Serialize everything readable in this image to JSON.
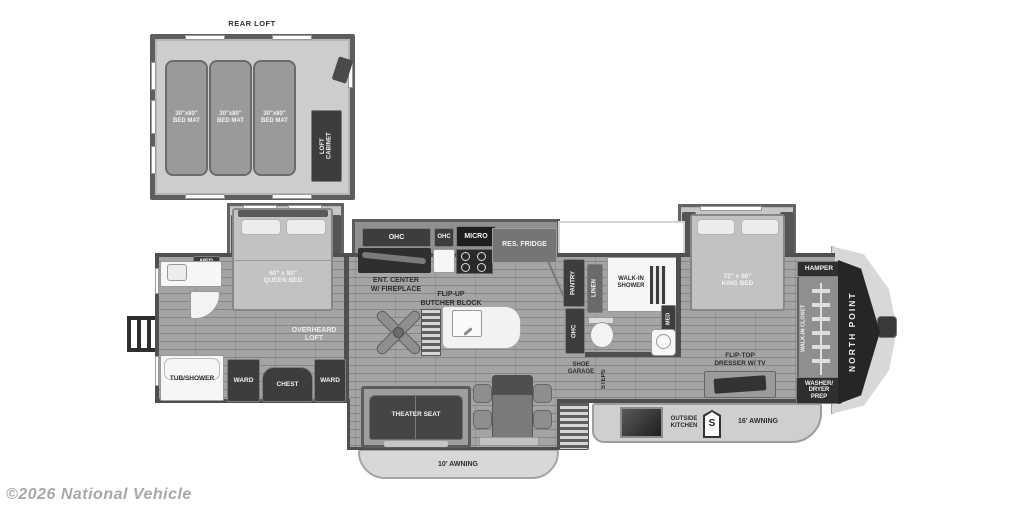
{
  "watermark": {
    "text": "©2026 National Vehicle"
  },
  "colors": {
    "background": "#ffffff",
    "wall": "#4f4f4f",
    "floor": "#a4a4a4",
    "slide_floor": "#c6c6c6",
    "dark_cabinet": "#3d3d3d",
    "white_fixture": "#f6f6f6",
    "bed": "#c2c2c2",
    "front_cap": "#262626",
    "watermark_gray": "#a8a8a8"
  },
  "rear_loft": {
    "title": "REAR LOFT",
    "mats": [
      "30\"x80\"\nBED MAT",
      "30\"x80\"\nBED MAT",
      "30\"x80\"\nBED MAT"
    ],
    "cabinet": "LOFT\nCABINET"
  },
  "bedroom": {
    "med": "MED",
    "queen_bed": "60\" x 80\"\nQUEEN BED",
    "overhead_loft": "OVERHEARD\nLOFT",
    "tub_shower": "TUB/SHOWER",
    "ward_left": "WARD",
    "chest": "CHEST",
    "ward_right": "WARD"
  },
  "kitchen": {
    "ohc_left": "OHC",
    "ohc_right": "OHC",
    "micro": "MICRO",
    "fridge": "RES. FRIDGE",
    "ent_center": "ENT. CENTER\nW/ FIREPLACE",
    "butcher_block": "FLIP-UP\nBUTCHER BLOCK"
  },
  "mid_bath": {
    "pantry": "PANTRY",
    "ohc": "OHC",
    "linen": "LINEN",
    "shower": "WALK-IN\nSHOWER",
    "med": "MED",
    "shoe_garage": "SHOE\nGARAGE",
    "steps": "STEPS"
  },
  "living": {
    "theater_seat": "THEATER SEAT",
    "awning": "10' AWNING"
  },
  "master": {
    "king_bed": "72\" x 80\"\nKING BED",
    "dresser": "FLIP-TOP\nDRESSER W/ TV",
    "hamper": "HAMPER",
    "closet": "WALK-IN CLOSET",
    "washer": "WASHER/\nDRYER\nPREP",
    "brand": "NORTH POINT"
  },
  "exterior": {
    "outside_kitchen": "OUTSIDE\nKITCHEN",
    "badge": "S",
    "awning": "16' AWNING"
  }
}
